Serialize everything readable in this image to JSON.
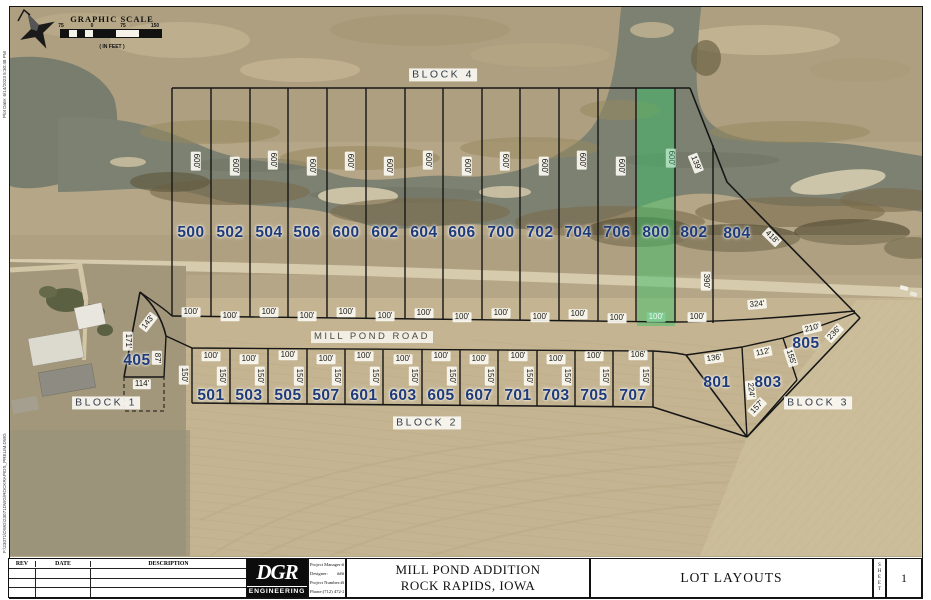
{
  "margin_notes": {
    "plot_date": "Plot Date: 6/14/2023 5:30:48 PM",
    "file_path": "F:\\23071\\DWG\\23071DWG\\ROCKRAPIDS_PRELIM.DWG"
  },
  "map": {
    "scale": {
      "title": "GRAPHIC SCALE",
      "ticks": [
        "75",
        "0",
        "75",
        "150"
      ],
      "units": "( IN FEET )"
    },
    "road_label": "MILL POND ROAD",
    "block_labels": [
      "BLOCK 1",
      "BLOCK 2",
      "BLOCK 3",
      "BLOCK 4"
    ],
    "highlight_color": "#4fc16e",
    "lot_number_color": "#1e3a78",
    "top_lots": [
      {
        "n": "500",
        "depth": "600'",
        "width": "100'"
      },
      {
        "n": "502",
        "depth": "600'",
        "width": "100'"
      },
      {
        "n": "504",
        "depth": "600'",
        "width": "100'"
      },
      {
        "n": "506",
        "depth": "600'",
        "width": "100'"
      },
      {
        "n": "600",
        "depth": "600'",
        "width": "100'"
      },
      {
        "n": "602",
        "depth": "600'",
        "width": "100'"
      },
      {
        "n": "604",
        "depth": "600'",
        "width": "100'"
      },
      {
        "n": "606",
        "depth": "600'",
        "width": "100'"
      },
      {
        "n": "700",
        "depth": "600'",
        "width": "100'"
      },
      {
        "n": "702",
        "depth": "600'",
        "width": "100'"
      },
      {
        "n": "704",
        "depth": "600'",
        "width": "100'"
      },
      {
        "n": "706",
        "depth": "600'",
        "width": "100'"
      },
      {
        "n": "800",
        "depth": "600'",
        "width": "100'",
        "highlighted": true
      },
      {
        "n": "802",
        "width": "100'"
      },
      {
        "n": "804"
      }
    ],
    "bottom_lots": [
      {
        "n": "501",
        "width": "100'",
        "depth": "150'"
      },
      {
        "n": "503",
        "width": "100'",
        "depth": "150'"
      },
      {
        "n": "505",
        "width": "100'",
        "depth": "150'"
      },
      {
        "n": "507",
        "width": "100'",
        "depth": "150'"
      },
      {
        "n": "601",
        "width": "100'",
        "depth": "150'"
      },
      {
        "n": "603",
        "width": "100'",
        "depth": "150'"
      },
      {
        "n": "605",
        "width": "100'",
        "depth": "150'"
      },
      {
        "n": "607",
        "width": "100'",
        "depth": "150'"
      },
      {
        "n": "701",
        "width": "100'",
        "depth": "150'"
      },
      {
        "n": "703",
        "width": "100'",
        "depth": "150'"
      },
      {
        "n": "705",
        "width": "100'",
        "depth": "150'"
      },
      {
        "n": "707",
        "width": "106'",
        "depth": "150'"
      }
    ],
    "west_lot": {
      "n": "405",
      "dim_143": "143'",
      "dim_171": "171'",
      "dim_87": "87'",
      "dim_114": "114'",
      "extra_150": "150'"
    },
    "east_area": {
      "n801": "801",
      "n803": "803",
      "n805": "805",
      "dim_139": "139'",
      "dim_418": "418'",
      "dim_390": "390'",
      "dim_324": "324'",
      "dim_210": "210'",
      "dim_236": "236'",
      "dim_112": "112'",
      "dim_155": "155'",
      "dim_136": "136'",
      "dim_224": "224'",
      "dim_157": "157'"
    }
  },
  "title_block": {
    "revisions": {
      "headers": [
        "REV",
        "DATE",
        "DESCRIPTION"
      ]
    },
    "logo": {
      "name": "DGR",
      "subtitle": "ENGINEERING"
    },
    "info": [
      {
        "label": "Project Manager:",
        "value": "###"
      },
      {
        "label": "Designer:",
        "value": "###"
      },
      {
        "label": "Project Number:",
        "value": "######"
      },
      {
        "label": "Phone:",
        "value": "(712) 472-2531"
      }
    ],
    "project_title": [
      "MILL POND ADDITION",
      "ROCK RAPIDS, IOWA"
    ],
    "sheet_title": "LOT LAYOUTS",
    "sheet_label": "SHEET",
    "sheet_number": "1"
  }
}
